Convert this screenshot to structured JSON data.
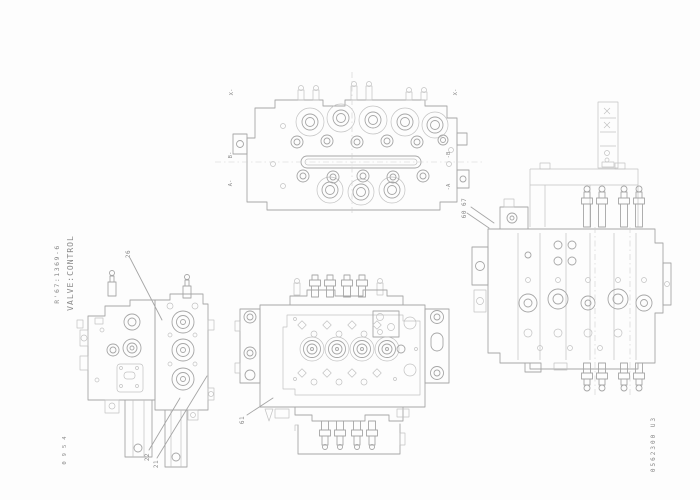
{
  "page": {
    "background": "#fdfdfd",
    "line_color": "#a6a6a6",
    "light_line_color": "#c2c2c2",
    "text_color": "#8a8a8a"
  },
  "title_block": {
    "part_number": "R'67:1369-6",
    "title": "VALVE:CONTROL"
  },
  "footer": {
    "doc_number": "0562300 U3",
    "corner_code": "0954"
  },
  "callouts": {
    "group_60_67": "60 67",
    "item_26": "26",
    "item_22": "22",
    "item_21": "21",
    "item_61": "61"
  },
  "section_markers": {
    "x_left": "X-",
    "x_right": "X-",
    "b_left": "B-",
    "a_left": "A-",
    "b_right": "-B",
    "a_right": "-A"
  }
}
